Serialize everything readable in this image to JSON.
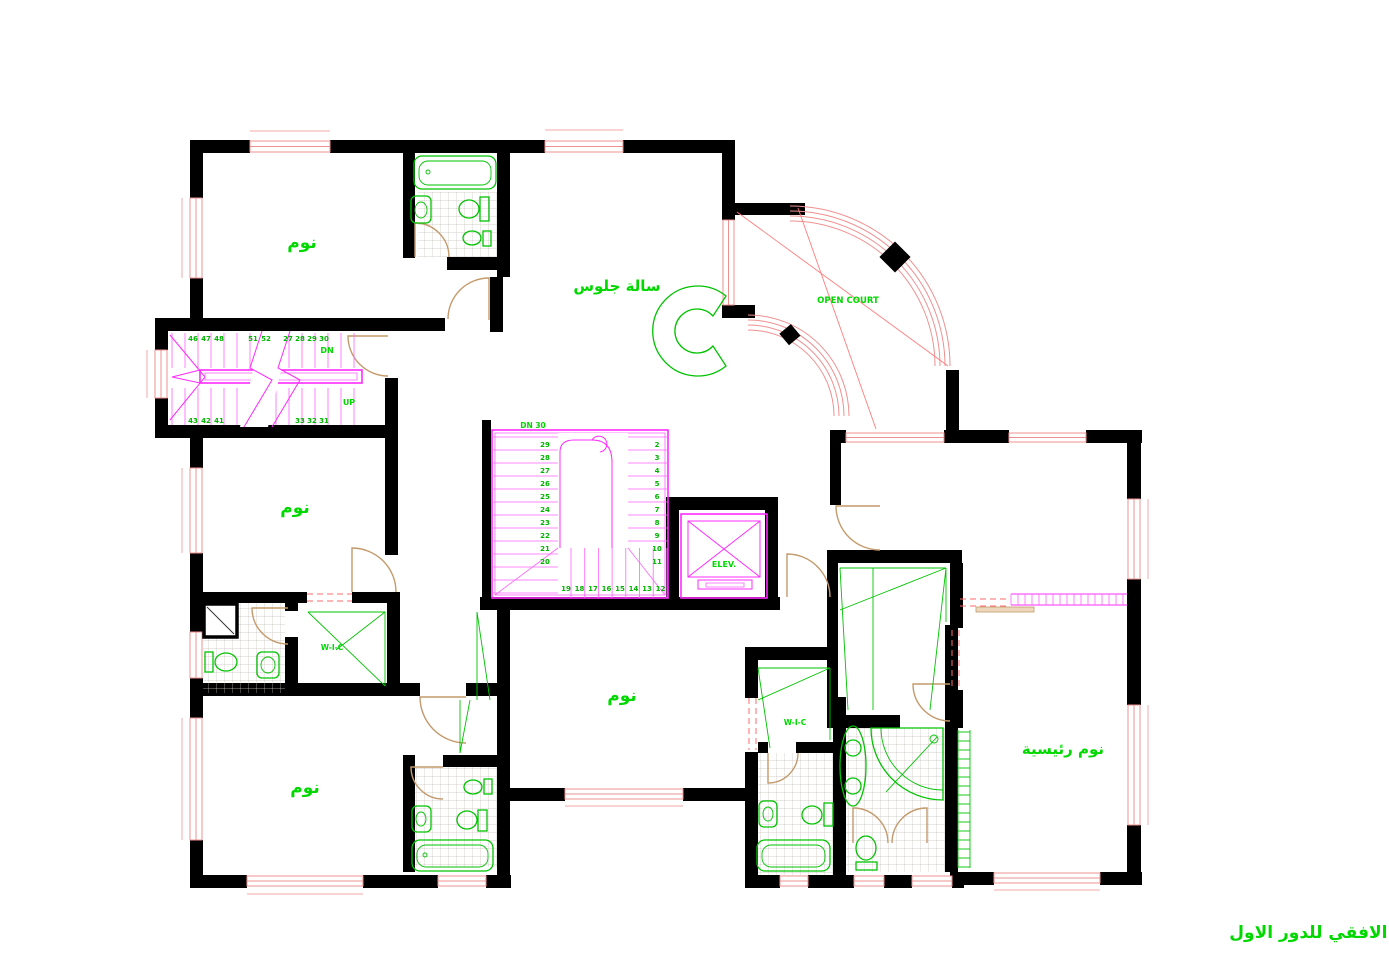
{
  "title": "المسقط الافقي للدور الاول",
  "labels": {
    "bedroom": "نوم",
    "sitting_hall": "سالة جلوس",
    "master_bedroom": "نوم رئيسية",
    "open_court": "OPEN COURT",
    "walk_in_closet": "W-I-C",
    "elevator": "ELEV.",
    "down": "DN",
    "up": "UP",
    "down_30": "DN  30"
  },
  "stairs": {
    "central": {
      "left_column": [
        "29",
        "28",
        "27",
        "26",
        "25",
        "24",
        "23",
        "22",
        "21",
        "20"
      ],
      "right_column": [
        "2",
        "3",
        "4",
        "5",
        "6",
        "7",
        "8",
        "9",
        "10",
        "11"
      ],
      "bottom_row": [
        "19",
        "18",
        "17",
        "16",
        "15",
        "14",
        "13",
        "12"
      ]
    },
    "hall": {
      "top_left": [
        "46",
        "47",
        "48"
      ],
      "top_mid": [
        "51",
        "52"
      ],
      "top_right": [
        "27",
        "28",
        "29",
        "30"
      ],
      "bottom_left": [
        "43",
        "42",
        "41"
      ],
      "bottom_right": [
        "33",
        "32",
        "31"
      ]
    }
  },
  "colors": {
    "wall": "#000000",
    "window": "#ef9090",
    "stair": "#ff2bff",
    "fixture": "#00c300",
    "label": "#00d800",
    "door": "#c49a6c",
    "opening_dash": "#ff6b6b"
  }
}
